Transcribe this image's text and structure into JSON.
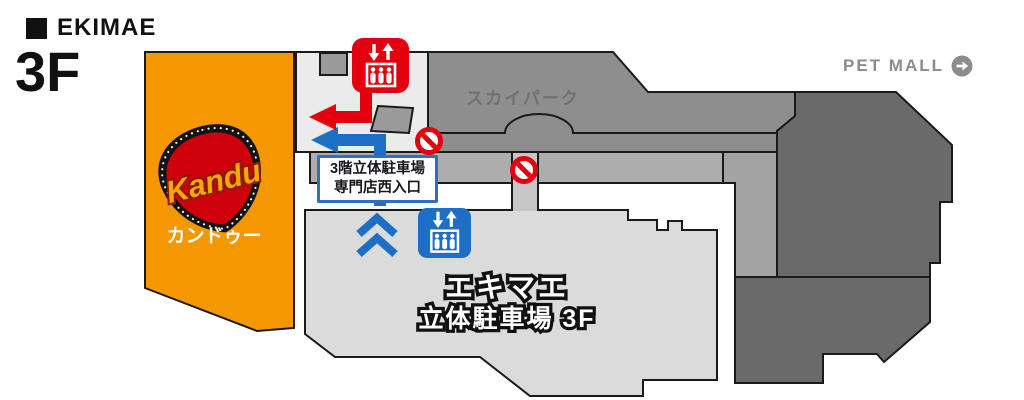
{
  "header": {
    "title": "EKIMAE",
    "floor": "3F"
  },
  "links": {
    "pet_mall": {
      "label": "PET MALL",
      "icon": "arrow-right-circle-icon"
    }
  },
  "map": {
    "regions": {
      "kandu": {
        "label": "カンドゥー",
        "logo_text": "Kandu",
        "color": "#F39800"
      },
      "skypark": {
        "label": "スカイパーク",
        "color": "#8E8E8E"
      },
      "parking": {
        "label_line1": "エキマエ",
        "label_line2": "立体駐車場 3F",
        "color": "#DBDBDB"
      },
      "petmall_building": {
        "color": "#6A6A6A"
      },
      "southeast_building": {
        "color": "#6A6A6A"
      },
      "west_corridor": {
        "color": "#EBEBEB"
      },
      "corridor_band": {
        "color": "#ADADAD"
      },
      "corridor_strip": {
        "color": "#A3A3A3"
      },
      "vertical_corridor": {
        "color": "#C6C6C6"
      }
    },
    "entrance_sign": {
      "line1": "3階立体駐車場",
      "line2": "専門店西入口"
    },
    "icons": {
      "elevator_red": {
        "name": "elevator-icon",
        "color": "#E3000F"
      },
      "elevator_blue": {
        "name": "elevator-icon",
        "color": "#1C6FC4"
      },
      "no_entry": {
        "name": "no-entry-icon",
        "color": "#E3000F"
      },
      "up_chevrons": {
        "name": "chevrons-up-icon",
        "color": "#1C6FC4"
      }
    },
    "colors": {
      "route_red": "#E3000F",
      "route_blue": "#1C6FC4",
      "outline": "#1A1A1A",
      "logo_red": "#CE000C",
      "logo_gold": "#F7A600"
    }
  }
}
